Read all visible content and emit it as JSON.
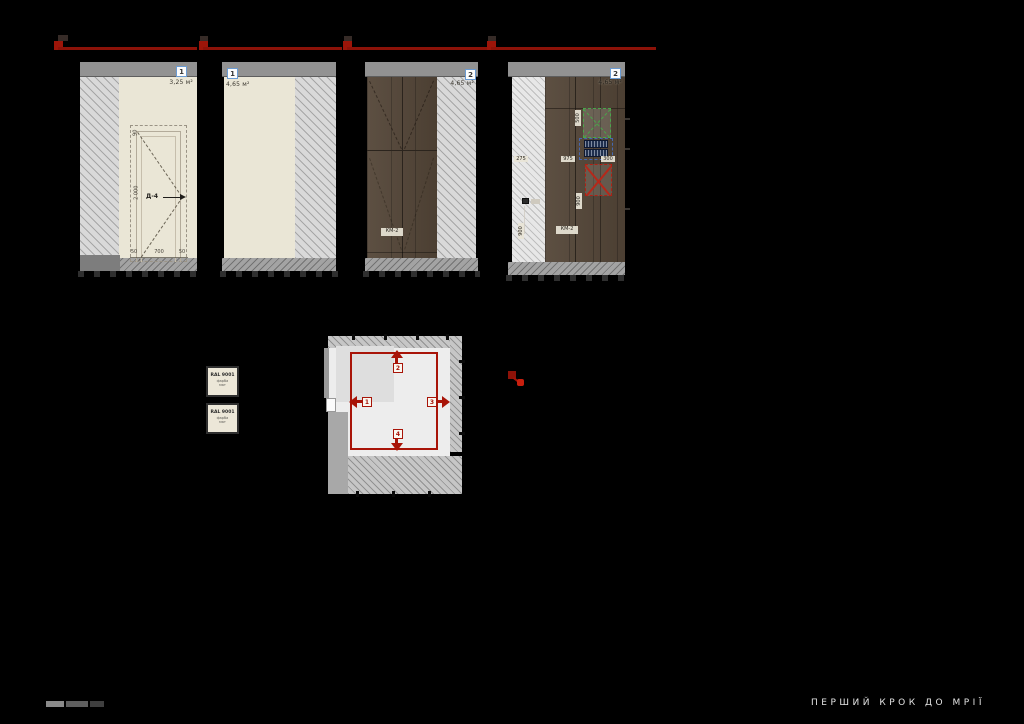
{
  "sheet": {
    "background": "#000000",
    "accent_red": "#a51408",
    "badge_border_blue": "#6b9bd2",
    "wood_brown": "#544638",
    "wall_cream": "#eae6d6"
  },
  "elevations": [
    {
      "badge": "1",
      "area": "3,25 м²",
      "door": {
        "label": "Д-4",
        "height_dim": "2 000",
        "top_dim": "90",
        "bottom_dims": [
          "50",
          "700",
          "50"
        ]
      }
    },
    {
      "badge": "1",
      "area": "4,65 м²"
    },
    {
      "badge": "2",
      "area": "4,65 м²",
      "furniture_label": "КМ-2"
    },
    {
      "badge": "2",
      "area": "4,65 м²",
      "furniture_label": "КМ-2",
      "dims": {
        "horizontal": [
          "275",
          "975",
          "300"
        ],
        "appliance_height": "500",
        "panel_height": "900",
        "wall_height": "900"
      }
    }
  ],
  "swatches": [
    {
      "code": "RAL 9001",
      "line2": "фарба",
      "line3": "мат"
    },
    {
      "code": "RAL 9001",
      "line2": "фарба",
      "line3": "мат"
    }
  ],
  "plan": {
    "view_markers": [
      {
        "num": "1"
      },
      {
        "num": "2"
      },
      {
        "num": "3"
      },
      {
        "num": "4"
      }
    ]
  },
  "footer": {
    "tagline": "ПЕРШИЙ КРОК ДО МРІЇ"
  }
}
